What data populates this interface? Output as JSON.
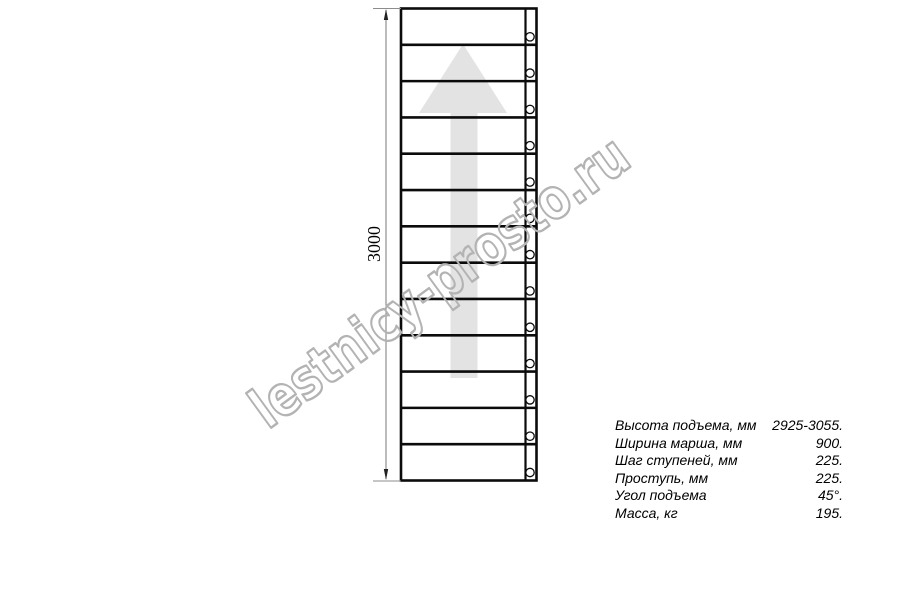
{
  "page": {
    "background": "#ffffff",
    "title": "staircase straight flight plan drawing"
  },
  "drawing": {
    "dimension": {
      "label": "3000"
    },
    "staircase": {
      "treads": 13,
      "bolt_count": 13,
      "direction_arrow": "up"
    },
    "colors": {
      "line": "#0b0b0b",
      "thin_line": "#8c8c8c",
      "arrow_fill": "#e3e3e3",
      "arrowhead": "#222222"
    }
  },
  "watermark": {
    "text": "lestnicy-prosto.ru",
    "color": "#b3b3b3"
  },
  "specs": {
    "rows": [
      {
        "label": "Высота подъема, мм",
        "value": "2925-3055."
      },
      {
        "label": "Ширина марша, мм",
        "value": "900."
      },
      {
        "label": "Шаг ступеней, мм",
        "value": "225."
      },
      {
        "label": "Проступь, мм",
        "value": "225."
      },
      {
        "label": "Угол подъема",
        "value": "45°."
      },
      {
        "label": "Масса, кг",
        "value": "195."
      }
    ]
  }
}
